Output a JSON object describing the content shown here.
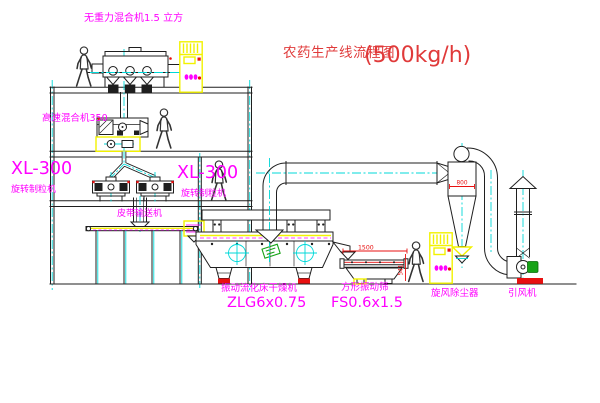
{
  "title": {
    "name": "农药生产线流程图",
    "capacity": "(500kg/h)"
  },
  "labels": {
    "gravity_mixer": "无重力混合机1.5 立方",
    "high_speed_mixer": "高速混合机350",
    "granulator_left_model": "XL-300",
    "granulator_left_name": "旋转制粒机",
    "granulator_right_model": "XL-300",
    "granulator_right_name": "旋转制粒机",
    "belt_conveyor": "皮带输送机",
    "dryer_name": "振动流化床干燥机",
    "dryer_model": "ZLG6x0.75",
    "sieve_name": "方形振动筛",
    "sieve_model": "FS0.6x1.5",
    "cyclone_name": "旋风除尘器",
    "fan_name": "引风机"
  },
  "dims": {
    "cyclone_body": "800",
    "sieve_length": "1500",
    "sieve_height": "541"
  },
  "colors": {
    "line": "#1f1f1f",
    "centerline": "#00d8d8",
    "label": "#ff00ff",
    "title_red": "#e03a3a",
    "accent_red": "#e81010",
    "highlight_yellow": "#f2f200",
    "accent_green": "#17a317",
    "person": "#333333",
    "background": "#ffffff"
  }
}
